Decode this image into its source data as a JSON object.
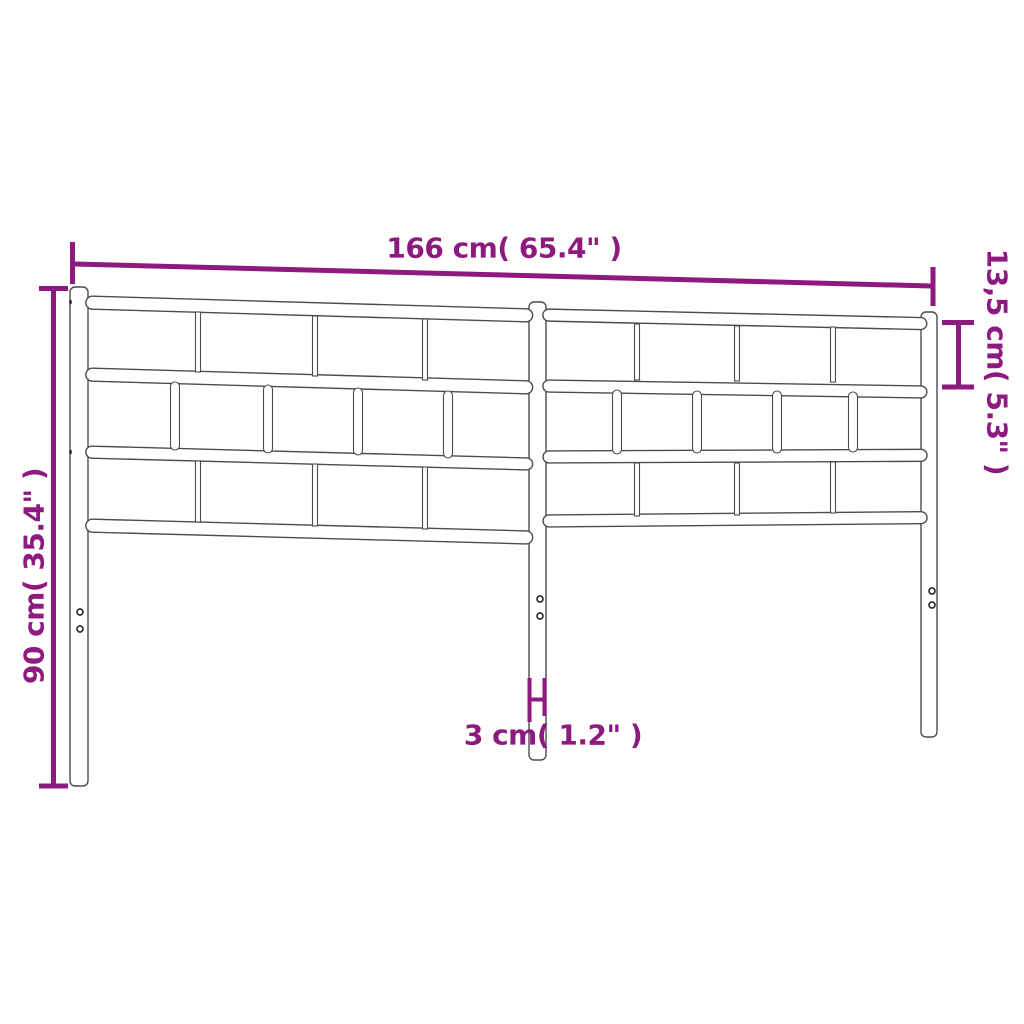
{
  "colors": {
    "dimension": "#8E1A7F",
    "outline": "#4c4c4c",
    "hole": "#333333",
    "background": "#ffffff"
  },
  "dimensions": {
    "width": {
      "cm": "166",
      "inches": "65.4",
      "label": "166 cm( 65.4\" )"
    },
    "panel_height": {
      "cm": "13,5",
      "inches": "5.3",
      "label": "13,5 cm( 5.3\" )"
    },
    "total_height": {
      "cm": "90",
      "inches": "35.4",
      "label": "90 cm( 35.4\" )"
    },
    "post_width": {
      "cm": "3",
      "inches": "1.2",
      "label": "3 cm( 1.2\" )"
    }
  }
}
